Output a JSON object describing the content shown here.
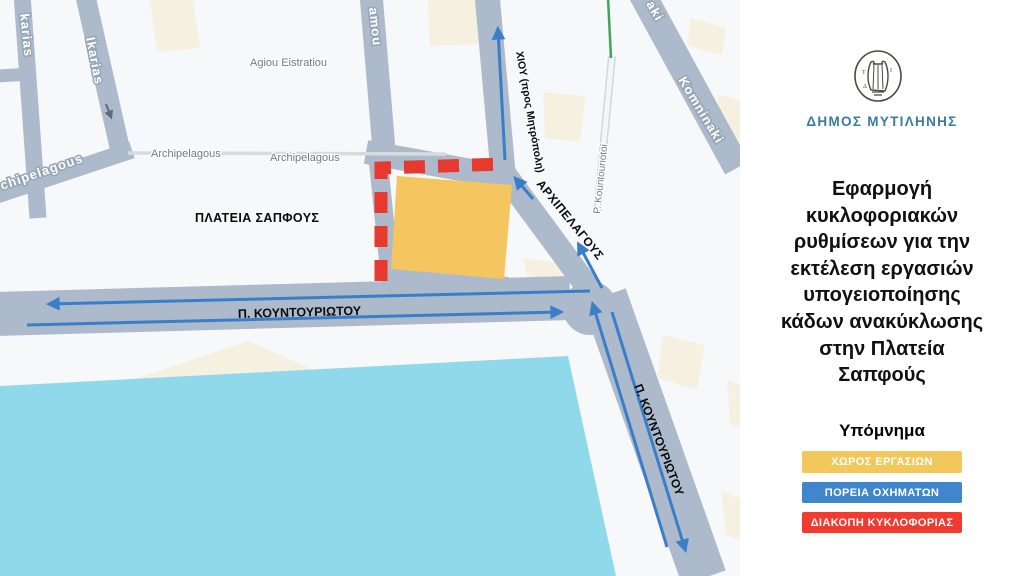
{
  "panel": {
    "municipality": "ΔΗΜΟΣ ΜΥΤΙΛΗΝΗΣ",
    "logo_icon": "lyre-seal-icon",
    "title_lines": [
      "Εφαρμογή",
      "κυκλοφοριακών",
      "ρυθμίσεων για την",
      "εκτέλεση εργασιών",
      "υπογειοποίησης",
      "κάδων ανακύκλωσης",
      "στην Πλατεία",
      "Σαπφούς"
    ],
    "legend": {
      "title": "Υπόμνημα",
      "items": [
        {
          "label": "ΧΩΡΟΣ ΕΡΓΑΣΙΩΝ",
          "color": "#F2C75C"
        },
        {
          "label": "ΠΟΡΕΙΑ ΟΧΗΜΑΤΩΝ",
          "color": "#3F86CB"
        },
        {
          "label": "ΔΙΑΚΟΠΗ ΚΥΚΛΟΦΟΡΙΑΣ",
          "color": "#F13B31"
        }
      ]
    }
  },
  "map": {
    "street_names": {
      "ikarias_left": "karias",
      "ikarias_right": "Ikarias",
      "agiou_eistratiou": "Agiou Eistratiou",
      "archipelagous_partial": "chipelagous",
      "archipelagous_1": "Archipelagous",
      "archipelagous_2": "Archipelagous",
      "amou_partial": "amou",
      "komninaki_partial": "aki",
      "komninaki": "Komninaki",
      "p_kountouriotoi": "P. Kountouriotoi"
    },
    "annotations": {
      "plateia_sapfous": "ΠΛΑΤΕΙΑ ΣΑΠΦΟΥΣ",
      "chiou": "ΧΙΟΥ (προς Μητρόπολη)",
      "arxipelagous": "ΑΡΧΙΠΕΛΑΓΟΥΣ",
      "kountouriotou_horizontal": "Π. ΚΟΥΝΤΟΥΡΙΩΤΟΥ",
      "kountouriotou_diagonal": "Π. ΚΟΥΝΤΟΥΡΙΩΤΟΥ"
    },
    "colors": {
      "work_area": "#F5C55F",
      "traffic_closure_dash": "#E8392E",
      "vehicle_route_arrow": "#3B7EC8",
      "water": "#90D9EB",
      "street": "#ACBACB",
      "building": "#F6F0E1",
      "background": "#F7F8F9"
    }
  }
}
